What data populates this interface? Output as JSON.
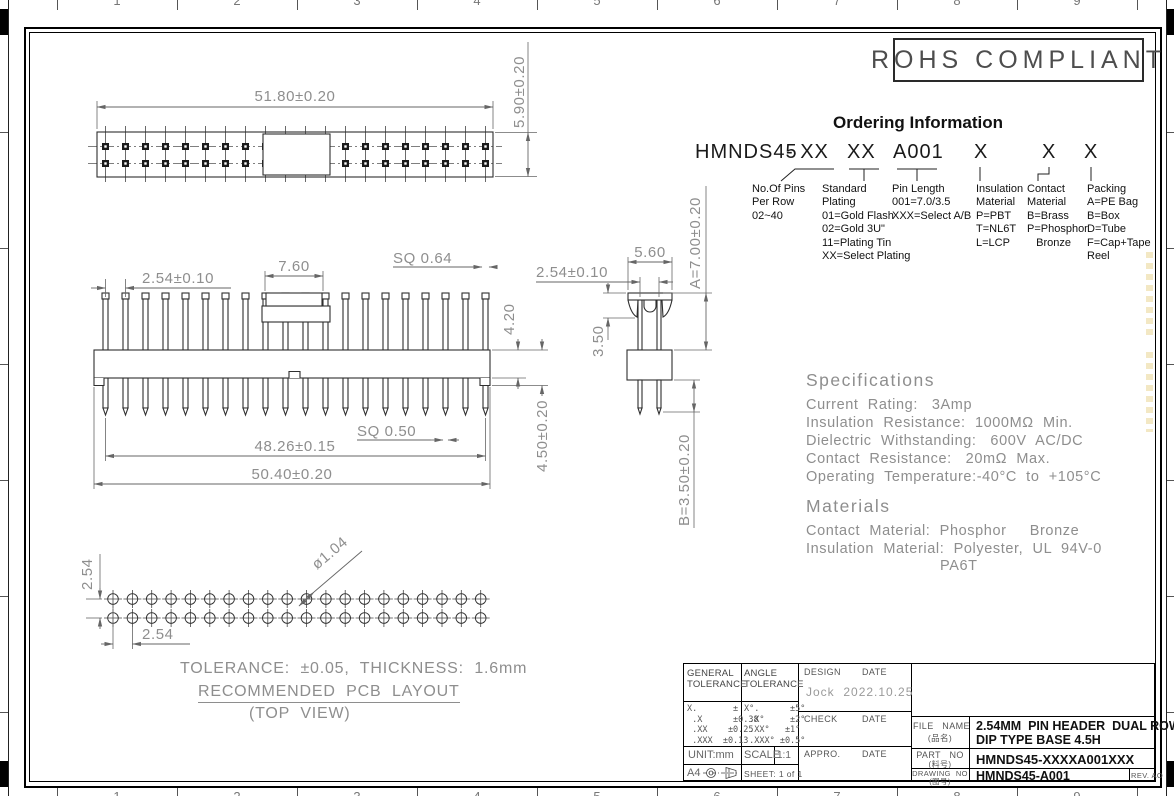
{
  "rohs": {
    "label": "ROHS COMPLIANT"
  },
  "ordering": {
    "title": "Ordering Information",
    "code": {
      "base": "HMNDS45",
      "p1": "- XX",
      "p2": "XX",
      "p3": "A001",
      "p4": "X",
      "p5": "X",
      "p6": "X"
    },
    "columns": [
      {
        "lines": [
          "No.Of Pins",
          "Per Row",
          "02~40"
        ]
      },
      {
        "lines": [
          "Standard",
          "Plating",
          "01=Gold Flash",
          "02=Gold 3U\"",
          "11=Plating Tin",
          "XX=Select Plating"
        ]
      },
      {
        "lines": [
          "Pin Length",
          "001=7.0/3.5",
          "XXX=Select A/B"
        ]
      },
      {
        "lines": [
          "Insulation",
          "Material",
          "P=PBT",
          "T=NL6T",
          "L=LCP"
        ]
      },
      {
        "lines": [
          "Contact",
          "Material",
          "B=Brass",
          "P=Phosphor",
          "   Bronze"
        ]
      },
      {
        "lines": [
          "Packing",
          "A=PE Bag",
          "B=Box",
          "D=Tube",
          "F=Cap+Tape",
          "Reel"
        ]
      }
    ]
  },
  "specifications": {
    "title": "Specifications",
    "lines": [
      "Current  Rating:   3Amp",
      "Insulation  Resistance:  1000MΩ  Min.",
      "Dielectric  Withstanding:   600V  AC/DC",
      "Contact  Resistance:   20mΩ  Max.",
      "Operating  Temperature:-40°C  to  +105°C"
    ]
  },
  "materials": {
    "title": "Materials",
    "lines": [
      "Contact  Material:  Phosphor     Bronze",
      "Insulation  Material:  Polyester,  UL  94V-0"
    ],
    "extra": "PA6T"
  },
  "dimensions": {
    "top_view_width": "51.80±0.20",
    "top_view_height": "5.90±0.20",
    "front_pitch": "2.54±0.10",
    "cap_width": "7.60",
    "pin_sq": "SQ  0.64",
    "body_height": "4.20",
    "tail_sq": "SQ  0.50",
    "pin_span": "48.26±0.15",
    "overall_width": "50.40±0.20",
    "base_height": "4.50±0.20",
    "side_width": "5.60",
    "side_pitch": "2.54±0.10",
    "dim_a": "A=7.00±0.20",
    "tab_height": "3.50",
    "dim_b": "B=3.50±0.20",
    "pcb_row_pitch": "2.54",
    "pcb_col_pitch": "2.54",
    "hole_dia": "ø1.04"
  },
  "notes": {
    "tolerance": "TOLERANCE:  ±0.05,  THICKNESS:  1.6mm",
    "pcb": "RECOMMENDED  PCB  LAYOUT",
    "view": "(TOP  VIEW)"
  },
  "title_block": {
    "general_tolerance_label": "GENERAL TOLERANCE",
    "angle_tolerance_label": "ANGLE TOLERANCE",
    "general_rows": [
      "X.       ±",
      " .X      ±0.38",
      " .XX    ±0.25",
      " .XXX  ±0.13"
    ],
    "angle_rows": [
      "X°.      ±5°",
      " .X°     ±2°",
      " .XX°   ±1°",
      " .XXX° ±0.5°"
    ],
    "design_label": "DESIGN",
    "check_label": "CHECK",
    "appro_label": "APPRO.",
    "date_label": "DATE",
    "designer": "Jock  2022.10.25",
    "unit": "UNIT:mm",
    "scale_label": "SCALE",
    "scale_value": "1:1",
    "size": "A4",
    "sheet": "SHEET: 1 of 1",
    "file_label": "FILE   NAME",
    "file_label_cn": "(品名)",
    "file_value_line1": "2.54MM  PIN HEADER  DUAL ROWS",
    "file_value_line2": "DIP TYPE BASE 4.5H",
    "part_label": "PART   NO",
    "part_label_cn": "(料号)",
    "part_value": "HMNDS45-XXXXA001XXX",
    "drawing_label": "DRAWING  NO",
    "drawing_label_cn": "(图号)",
    "drawing_value": "HMNDS45-A001",
    "rev": "REV. AO"
  },
  "zones": {
    "top": [
      "1",
      "2",
      "3",
      "4",
      "5",
      "6",
      "7",
      "8",
      "9"
    ],
    "bottom": [
      "1",
      "2",
      "3",
      "4",
      "5",
      "6",
      "7",
      "8",
      "9"
    ]
  }
}
